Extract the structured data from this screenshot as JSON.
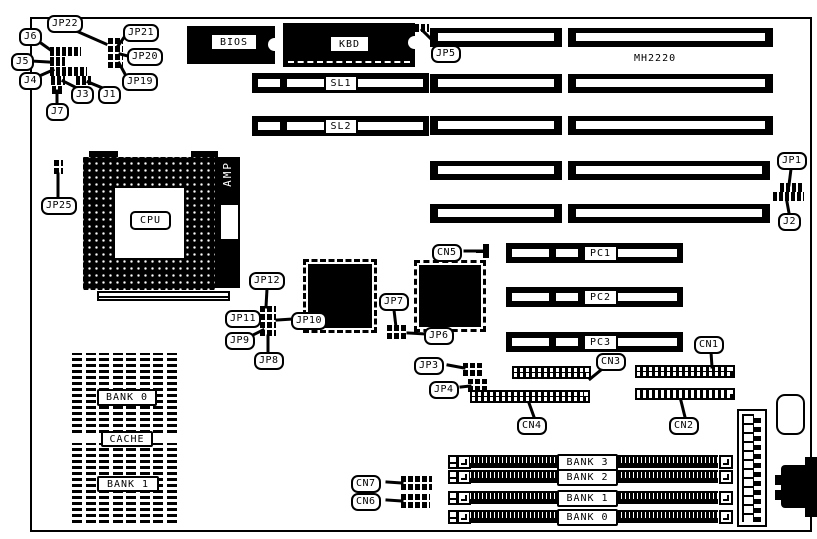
{
  "board": {
    "model_text": "MH2220"
  },
  "jumpers": {
    "jp22": "JP22",
    "jp21": "JP21",
    "jp20": "JP20",
    "jp19": "JP19",
    "jp25": "JP25",
    "jp12": "JP12",
    "jp11": "JP11",
    "jp10": "JP10",
    "jp9": "JP9",
    "jp8": "JP8",
    "jp7": "JP7",
    "jp6": "JP6",
    "jp5": "JP5",
    "jp4": "JP4",
    "jp3": "JP3",
    "jp1": "JP1",
    "j1": "J1",
    "j2": "J2",
    "j3": "J3",
    "j4": "J4",
    "j5": "J5",
    "j6": "J6",
    "j7": "J7"
  },
  "connectors": {
    "cn1": "CN1",
    "cn2": "CN2",
    "cn3": "CN3",
    "cn4": "CN4",
    "cn5": "CN5",
    "cn6": "CN6",
    "cn7": "CN7"
  },
  "chips": {
    "bios": "BIOS",
    "kbd": "KBD",
    "cpu": "CPU",
    "amp": "AMP"
  },
  "slots": {
    "sl1": "SL1",
    "sl2": "SL2",
    "pc1": "PC1",
    "pc2": "PC2",
    "pc3": "PC3"
  },
  "memory": {
    "cache": [
      "BANK 0",
      "CACHE",
      "BANK 1"
    ],
    "simm": [
      "BANK 3",
      "BANK 2",
      "BANK 1",
      "BANK 0"
    ]
  },
  "colors": {
    "component": "#000000",
    "board_bg": "#ffffff"
  }
}
